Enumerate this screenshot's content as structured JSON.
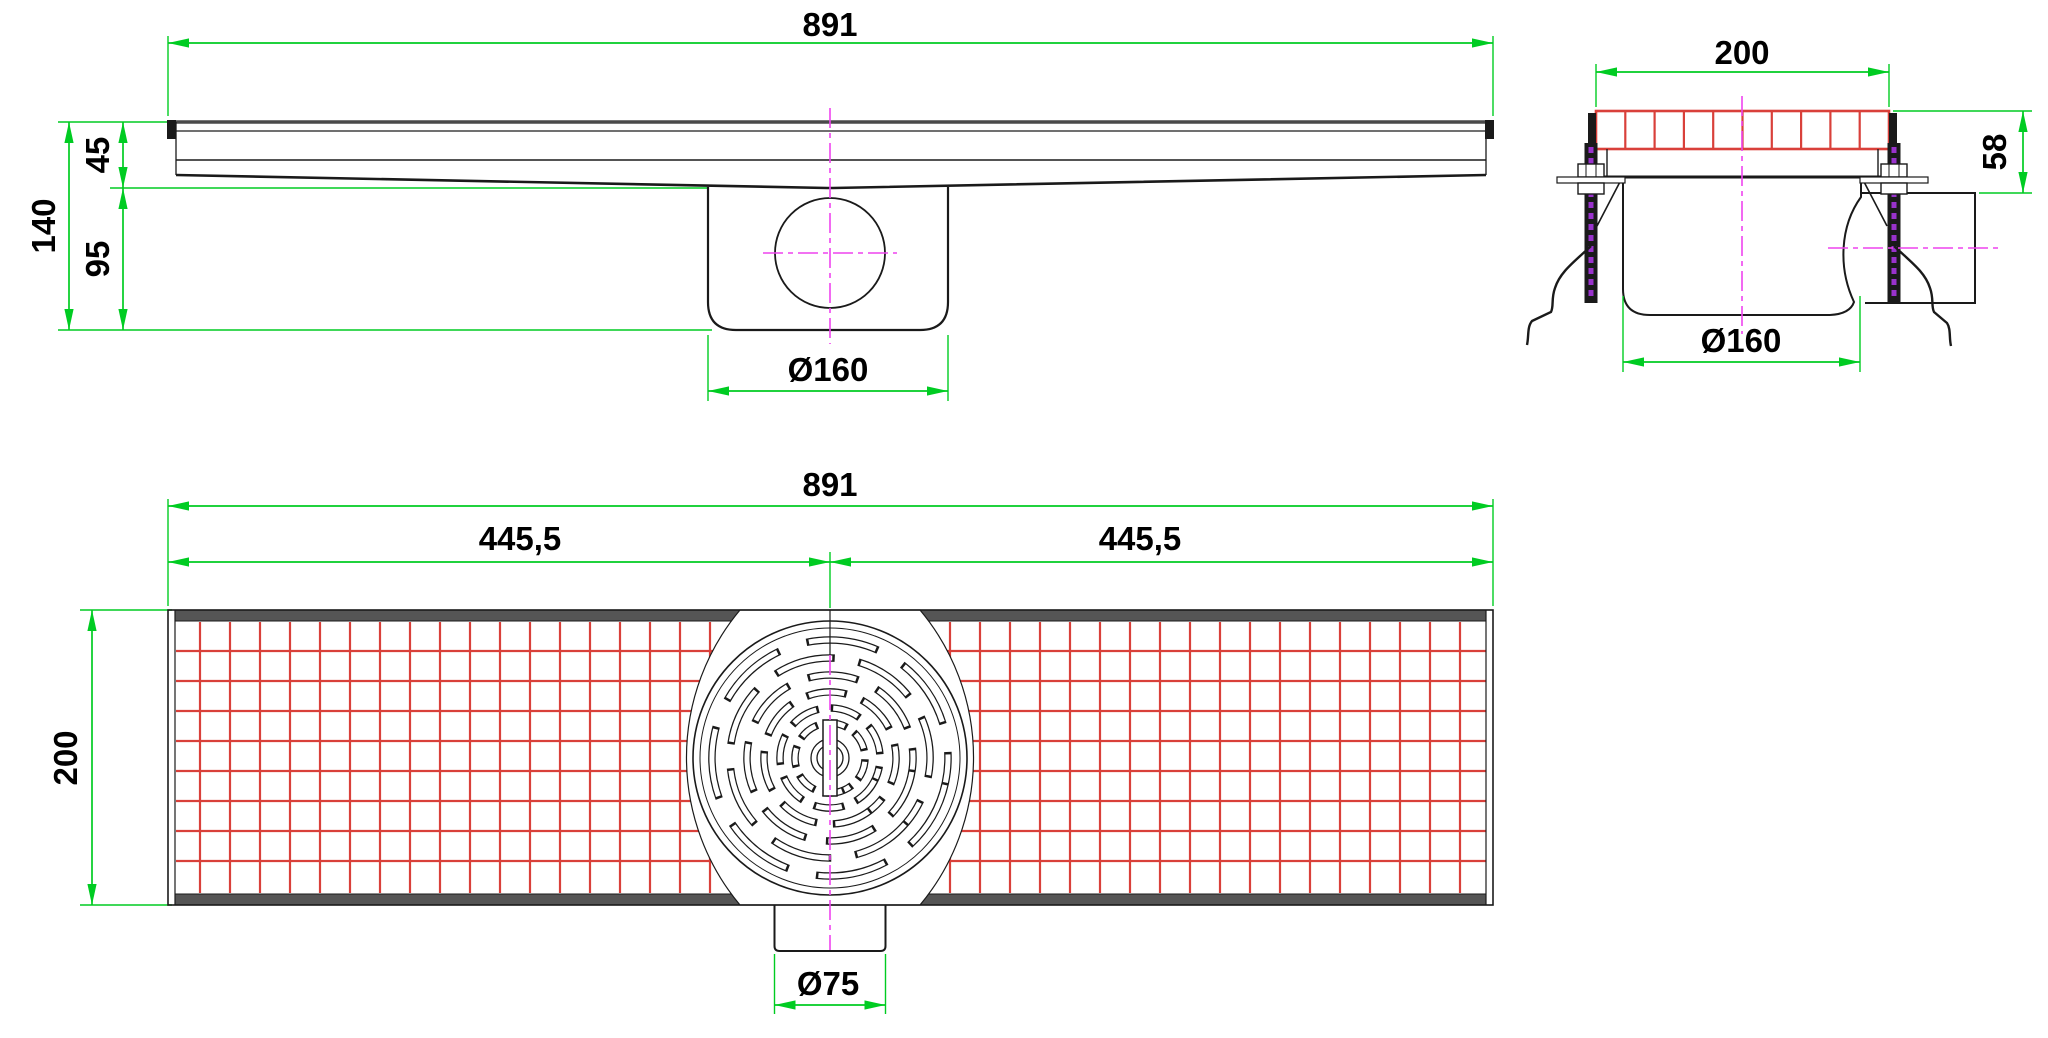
{
  "drawing": {
    "type": "technical-drawing",
    "subject": "channel-floor-drain",
    "colors": {
      "dimension_green": "#00cc22",
      "grate_red": "#d9403a",
      "centerline_magenta": "#ee44ee",
      "thread_purple": "#9932cc",
      "line_black": "#1a1a1a",
      "band_gray": "#555555"
    },
    "views": {
      "side": {
        "dims": {
          "overall_length": "891",
          "inlet_depth": "45",
          "sump_depth": "95",
          "total_depth": "140",
          "sump_diameter": "Ø160"
        }
      },
      "end": {
        "dims": {
          "grate_width": "200",
          "outlet_height": "58",
          "sump_diameter": "Ø160"
        },
        "grate_cells": 10
      },
      "plan": {
        "dims": {
          "overall_length": "891",
          "left_half": "445,5",
          "right_half": "445,5",
          "channel_width": "200",
          "outlet_diameter": "Ø75"
        },
        "mesh": {
          "pitch_px": 30,
          "h_lines": 8,
          "v_span": 21
        },
        "cover_ring_radii_px": [
          118,
          100,
          83,
          66,
          50,
          35
        ],
        "cover_ring_angles_deg": [
          12,
          40,
          8,
          52,
          24,
          66
        ]
      }
    }
  }
}
